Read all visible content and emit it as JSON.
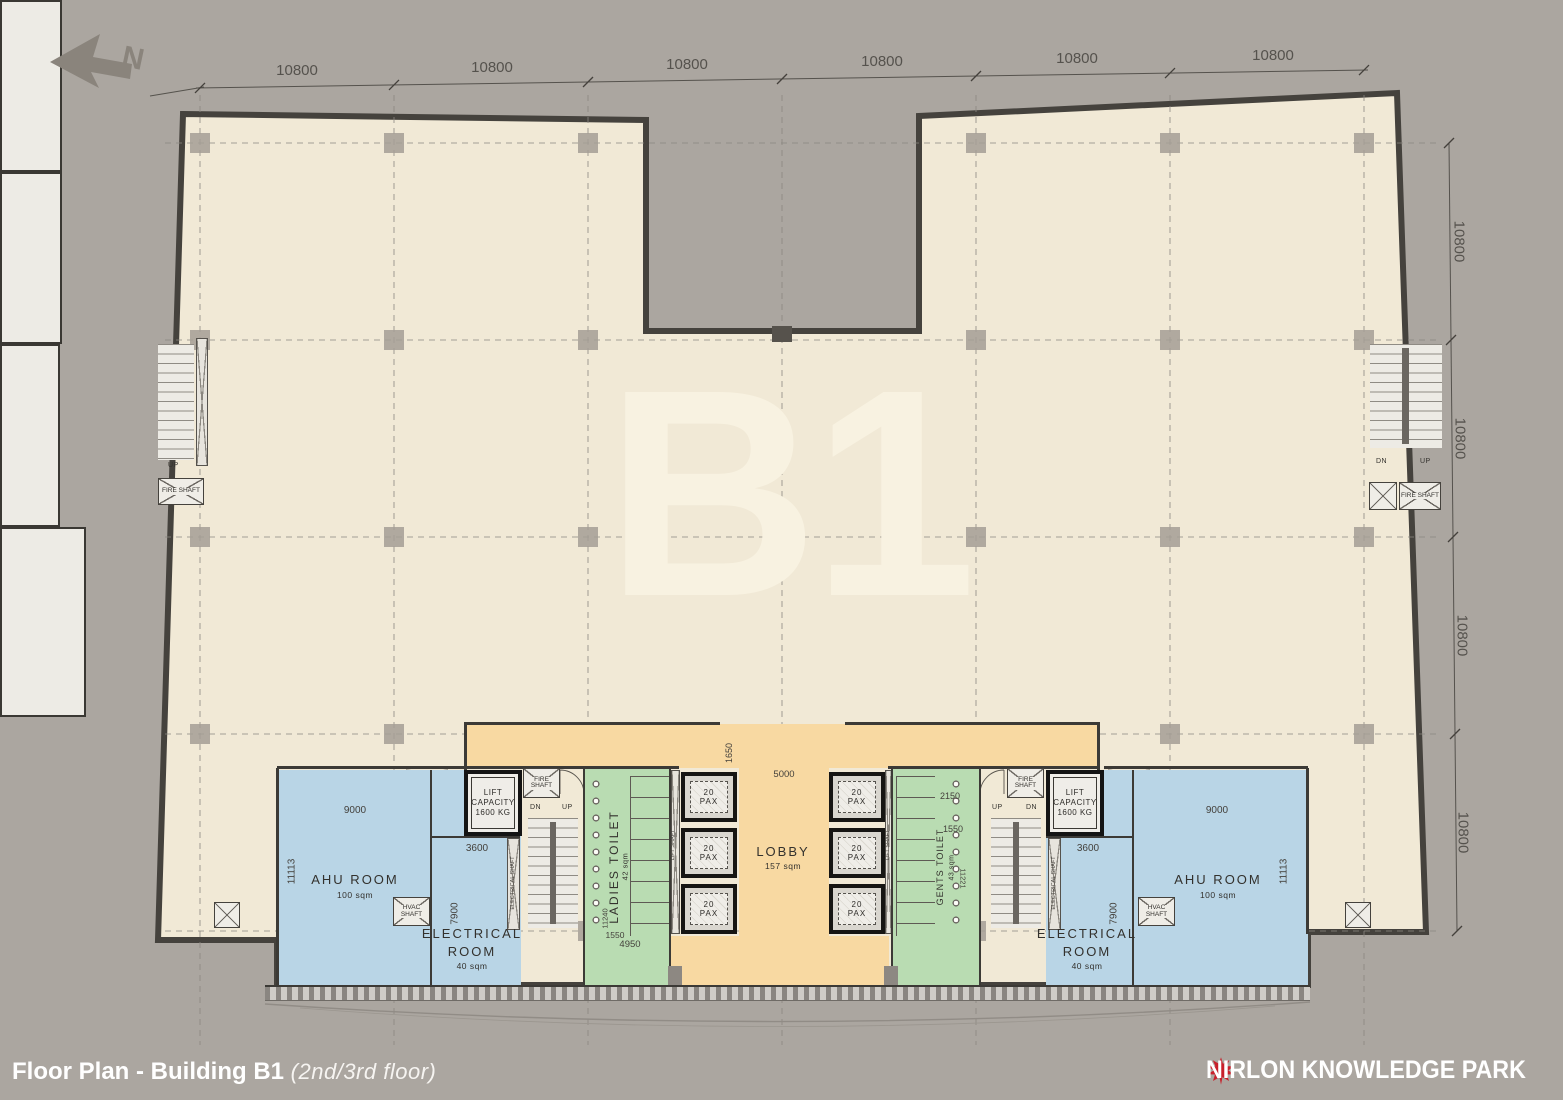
{
  "compass": {
    "label": "N"
  },
  "watermark": {
    "text": "B1"
  },
  "dims": {
    "top": [
      "10800",
      "10800",
      "10800",
      "10800",
      "10800",
      "10800"
    ],
    "right": [
      "10800",
      "10800",
      "10800",
      "10800"
    ],
    "lobby_width": "5000",
    "lobby_entry_depth": "1650",
    "ahu_width_left": "9000",
    "ahu_width_right": "9000",
    "ahu_depth_left": "11113",
    "ahu_depth_right": "11113",
    "elec_width_left": "3600",
    "elec_width_right": "3600",
    "elec_depth_left": "7900",
    "elec_depth_right": "7900",
    "ladies_width": "4950",
    "ladies_dim_small": "1550",
    "ladies_depth": "11240",
    "gents_dim_top": "2150",
    "gents_dim_small": "1550",
    "gents_depth": "11221"
  },
  "rooms": {
    "ahu": {
      "name": "AHU ROOM",
      "area": "100 sqm"
    },
    "electrical": {
      "name_line1": "ELECTRICAL",
      "name_line2": "ROOM",
      "area": "40 sqm"
    },
    "ladies_toilet": {
      "name": "LADIES TOILET",
      "area": "42 sqm"
    },
    "gents_toilet": {
      "name": "GENTS TOILET",
      "area": "43 sqm"
    },
    "lobby": {
      "name": "LOBBY",
      "area": "157 sqm"
    }
  },
  "lifts": {
    "cell_line1": "20",
    "cell_line2": "PAX",
    "capacity_line1": "LIFT",
    "capacity_line2": "CAPACITY",
    "capacity_line3": "1600 KG"
  },
  "shafts": {
    "fire": "FIRE SHAFT",
    "hvac": "HVAC SHAFT",
    "lift": "LIFT SHAFT",
    "electrical": "ELECTRICAL SHAFT"
  },
  "stairs": {
    "up": "UP",
    "dn": "DN"
  },
  "footer": {
    "title": "Floor Plan - Building B1",
    "subtitle": "(2nd/3rd floor)",
    "brand": "NIRLON KNOWLEDGE PARK"
  },
  "colors": {
    "background": "#aba6a0",
    "floor": "#f1e9d6",
    "lobby": "#f8d9a2",
    "toilet": "#b9dcb2",
    "service_room": "#b9d5e6",
    "wall": "#3c3a36",
    "brand_red": "#c8202b"
  }
}
